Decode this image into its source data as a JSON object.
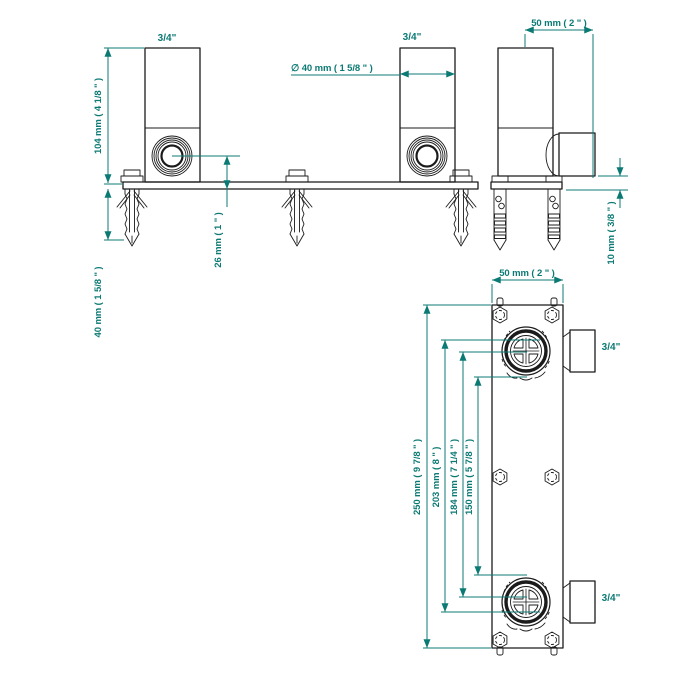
{
  "colors": {
    "dimension_accent": "#0c7a74",
    "drawing_line": "#1b1b1b",
    "background": "#ffffff"
  },
  "front_view": {
    "port_left_label": "3/4\"",
    "port_right_label": "3/4\"",
    "dim_height": "104 mm ( 4 1/8 \" )",
    "dim_anchor_depth": "40 mm ( 1 5/8 \" )",
    "dim_center_to_wall": "26 mm ( 1 \" )",
    "dim_body_diameter": "∅ 40 mm ( 1 5/8 \" )"
  },
  "side_view": {
    "dim_depth": "50 mm ( 2 \" )",
    "dim_plate_offset": "10 mm ( 3/8 \" )"
  },
  "plan_view": {
    "dim_width": "50 mm ( 2 \" )",
    "dim_overall_length": "250 mm ( 9 7/8 \" )",
    "dim_length_203": "203 mm ( 8 \" )",
    "dim_length_184": "184 mm ( 7 1/4 \" )",
    "dim_length_150": "150 mm ( 5 7/8 \" )",
    "port_top_label": "3/4\"",
    "port_bottom_label": "3/4\""
  }
}
